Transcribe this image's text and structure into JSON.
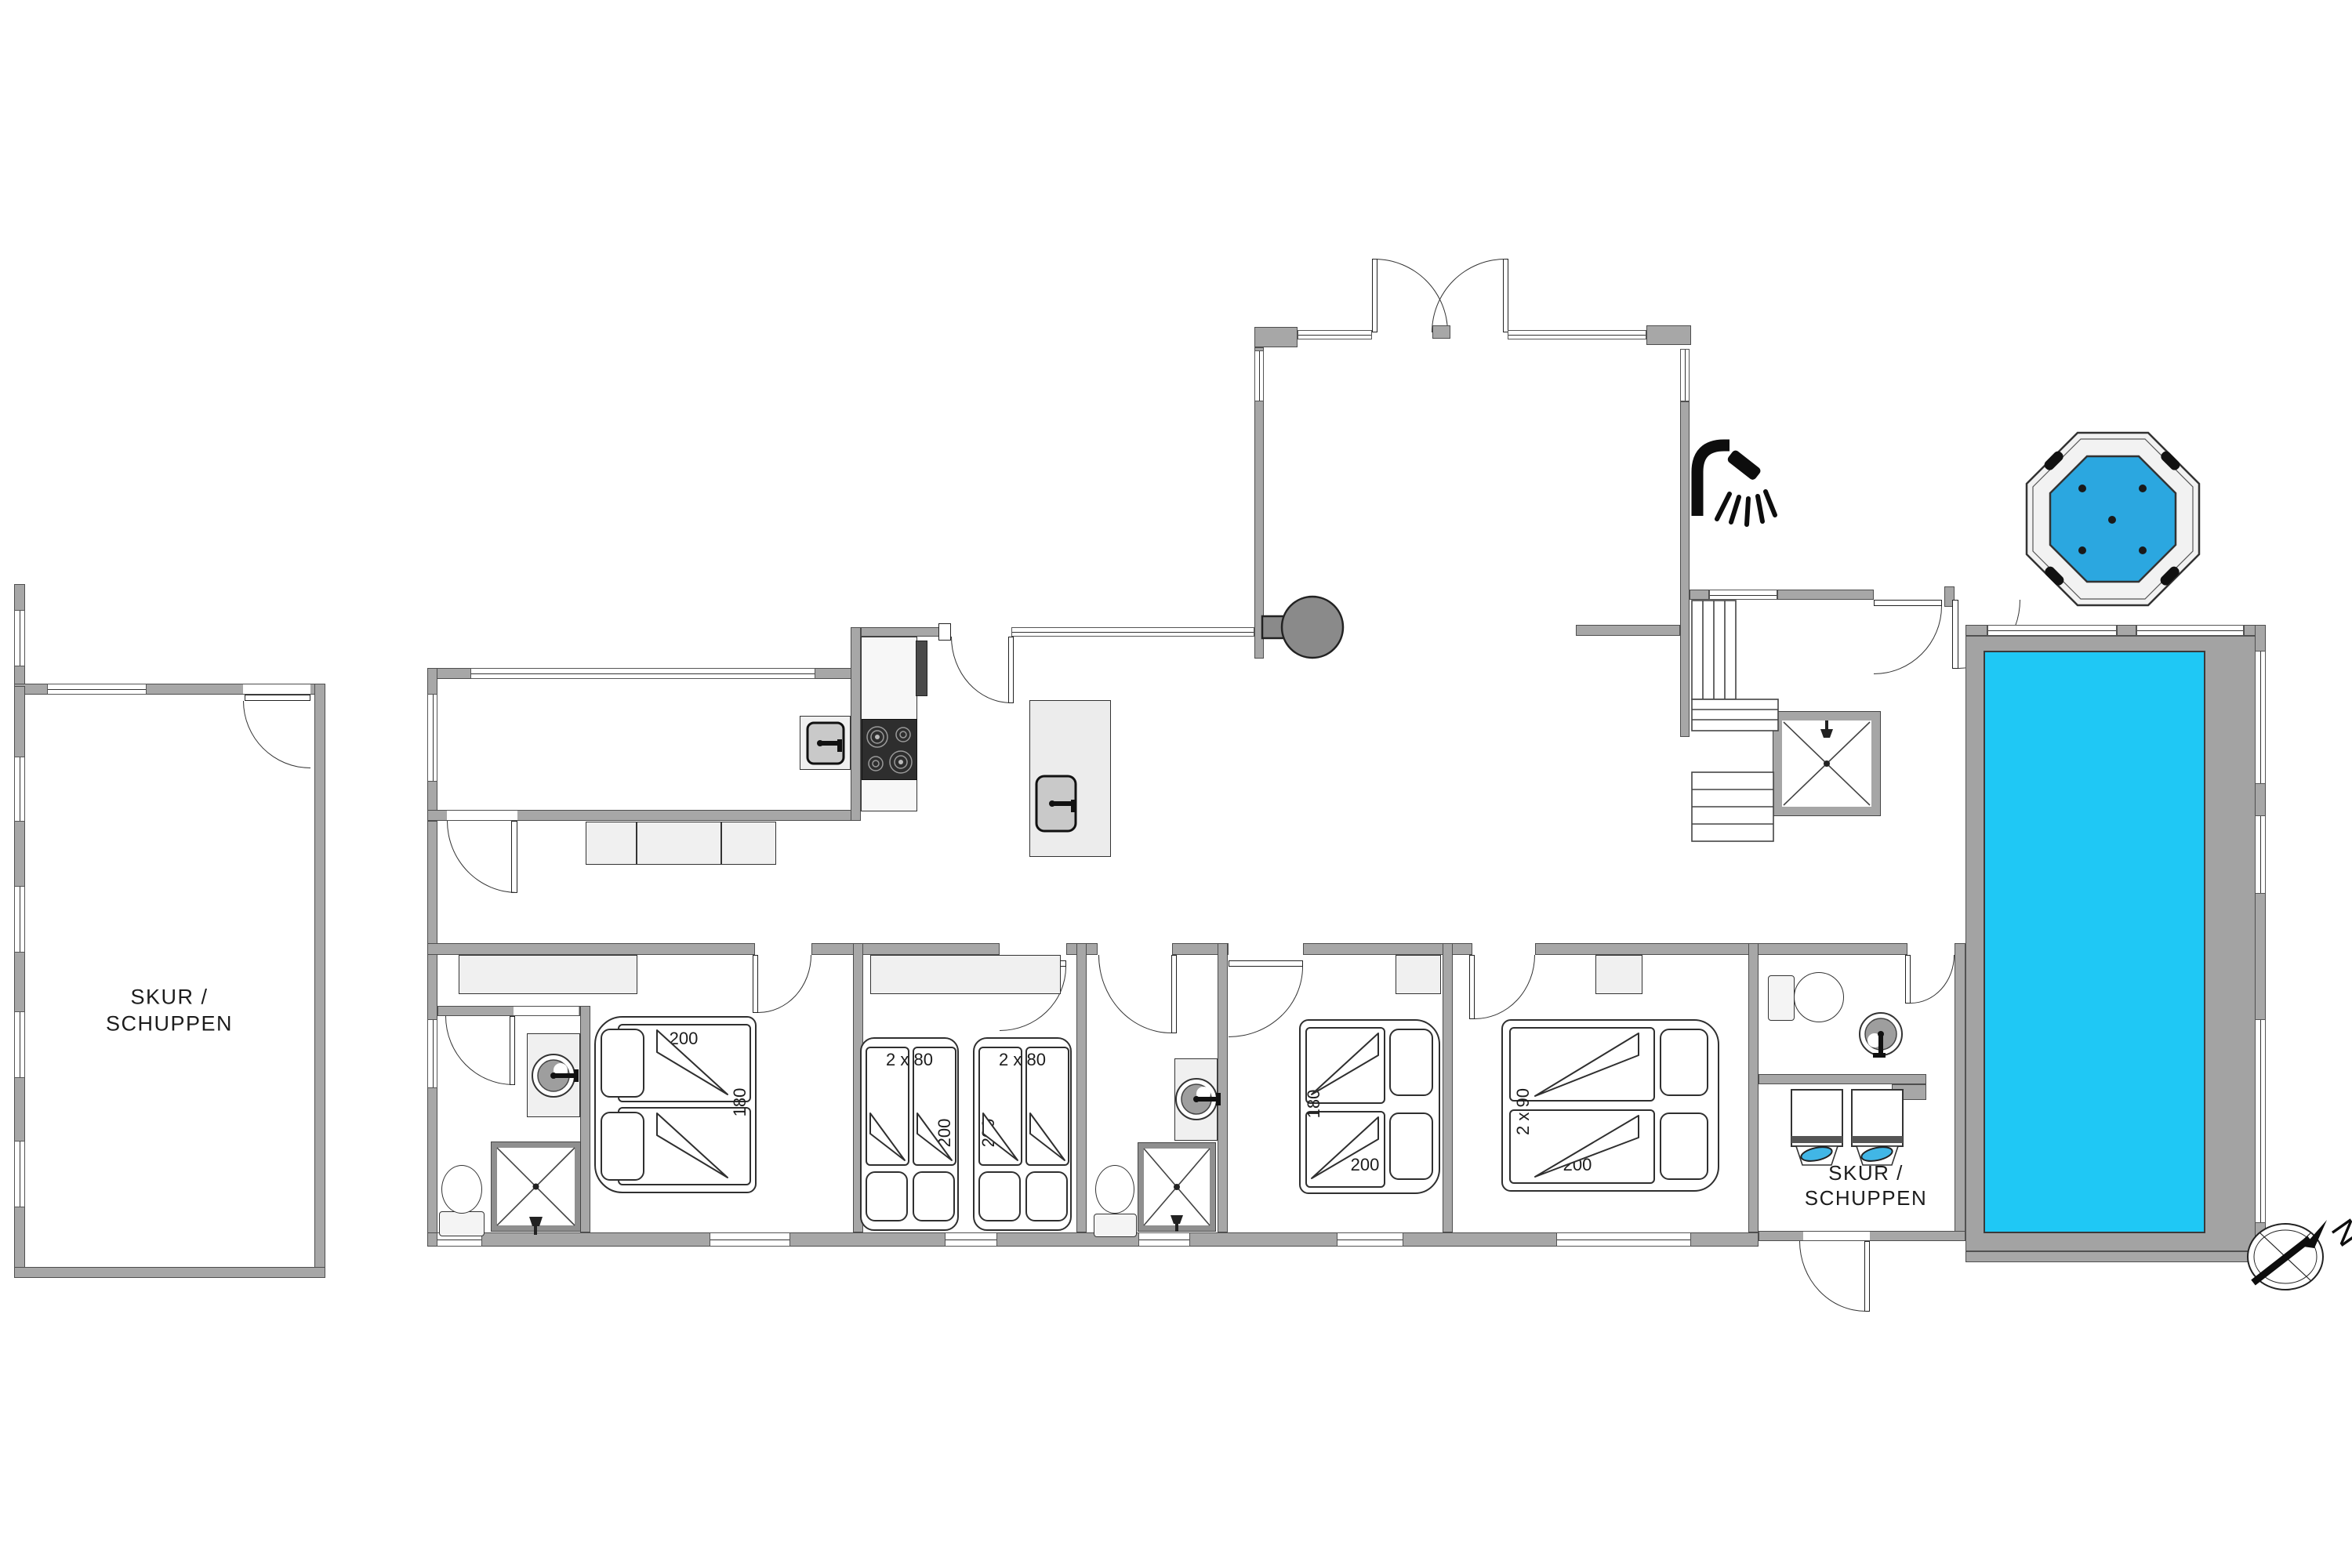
{
  "labels": {
    "shed_left": [
      "SKUR /",
      "SCHUPPEN"
    ],
    "shed_right": [
      "SKUR /",
      "SCHUPPEN"
    ],
    "compass_north": "N"
  },
  "beds": {
    "bedroom1": {
      "width": "200",
      "depth": "180"
    },
    "bedroom2_left": {
      "size": "2 x 80",
      "length": "200"
    },
    "bedroom2_right": {
      "size": "2 x 80",
      "length": "200"
    },
    "bedroom3": {
      "depth": "180",
      "length": "200"
    },
    "bedroom4": {
      "size": "2 x 90",
      "length": "200"
    }
  },
  "icons": {
    "outdoor_shower": "shower-head-icon",
    "cubicle_shower": "shower-head-icon",
    "compass": "compass-rose-icon",
    "hot_tub": "octagon-hot-tub-icon",
    "wood_stove": "round-stove-icon"
  },
  "colors": {
    "wall": "#a7a7a7",
    "wall_edge": "#4e4e4e",
    "pool_water": "#1fc8f5",
    "hot_tub_water": "#2ba7e0",
    "appliance_accent": "#41b6e6",
    "cooktop": "#2e2e2e",
    "stove_gray": "#8a8a8a",
    "furniture_fill": "#f0f0f0",
    "line": "#333333"
  }
}
